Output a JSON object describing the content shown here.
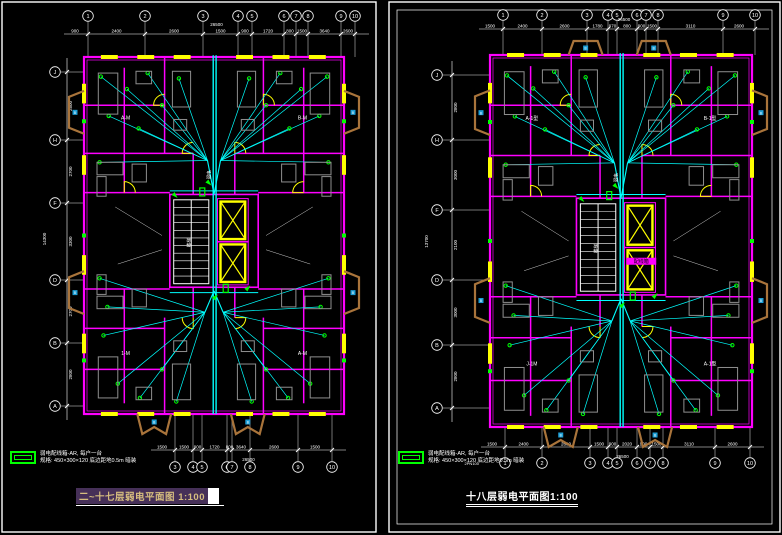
{
  "window": {
    "background": "#000000"
  },
  "colors": {
    "wall": "#FF00FF",
    "wire": "#00FFFF",
    "window_fill": "#FFFF00",
    "symbol": "#00FF00",
    "balcony": "#A9743B",
    "balcony_box": "#1E9FD6",
    "furniture": "#8F8F8F",
    "frame": "#FFFFFF",
    "dim_text": "#FFFFFF",
    "title_highlight_bg": "#463058",
    "title_highlight_text": "#D6BE7F"
  },
  "panels": [
    {
      "name": "left",
      "title": {
        "text": "二~十七层弱电平面图",
        "scale": "1:100"
      },
      "legend": {
        "line1": "弱电配线箱-AR, 每户一台",
        "line2": "规格: 450×300×120 底边距地0.5m 暗装"
      },
      "axes": {
        "top": {
          "labels": [
            "1",
            "2",
            "3",
            "4",
            "5",
            "6",
            "7",
            "8",
            "9",
            "10"
          ],
          "dims": [
            "2400",
            "2600",
            "1500",
            "900",
            "1720",
            "800",
            "1500",
            "3640",
            "2600"
          ],
          "lead": "900",
          "total": "26500"
        },
        "bottom": {
          "labels": [
            "3",
            "4",
            "5",
            "6",
            "7",
            "8",
            "9",
            "10"
          ],
          "dims": [
            "1500",
            "900",
            "1720",
            "800",
            "3640",
            "2600",
            "1500"
          ],
          "lead": "1500",
          "total": "26500"
        },
        "left": {
          "labels": [
            "J",
            "H",
            "F",
            "D",
            "B",
            "A"
          ],
          "dims": [
            "2800",
            "2700",
            "3300",
            "2700",
            "2800"
          ],
          "total": "14300"
        }
      },
      "room_labels": [
        "A-M",
        "B-M",
        "1-M",
        "A-M"
      ],
      "core_labels": {
        "stair": "楼梯",
        "riser": "弱电"
      },
      "balcony_tag": "B"
    },
    {
      "name": "right",
      "title": {
        "text": "十八层弱电平面图",
        "scale": "1:100"
      },
      "legend": {
        "line1": "弱电配线箱-AR, 每户一台",
        "line2": "规格: 450×300×120 底边距地0.5m 暗装"
      },
      "axes": {
        "top": {
          "labels": [
            "1",
            "2",
            "3",
            "4",
            "5",
            "6",
            "7",
            "8",
            "9",
            "10"
          ],
          "dims": [
            "2400",
            "2600",
            "1780",
            "970",
            "800",
            "900",
            "1500",
            "3110",
            "2600"
          ],
          "lead": "1500",
          "total": "26500"
        },
        "bottom": {
          "labels": [
            "1",
            "2",
            "3",
            "4",
            "5",
            "6",
            "7",
            "8",
            "9",
            "10"
          ],
          "dims": [
            "2400",
            "2600",
            "1500",
            "900",
            "2020",
            "900",
            "1500",
            "3110",
            "2600"
          ],
          "lead": "1500",
          "total": "26500",
          "note": "2PN100"
        },
        "left": {
          "labels": [
            "J",
            "H",
            "F",
            "D",
            "B",
            "A"
          ],
          "dims": [
            "2800",
            "3000",
            "2100",
            "3000",
            "2800"
          ],
          "total": "13700"
        }
      },
      "room_labels": [
        "A-1型",
        "B-1型",
        "J-1M",
        "A-1型"
      ],
      "core_labels": {
        "stair": "楼梯",
        "riser": "弱电"
      },
      "box_label": "配线箱",
      "balcony_tag": "B"
    }
  ]
}
